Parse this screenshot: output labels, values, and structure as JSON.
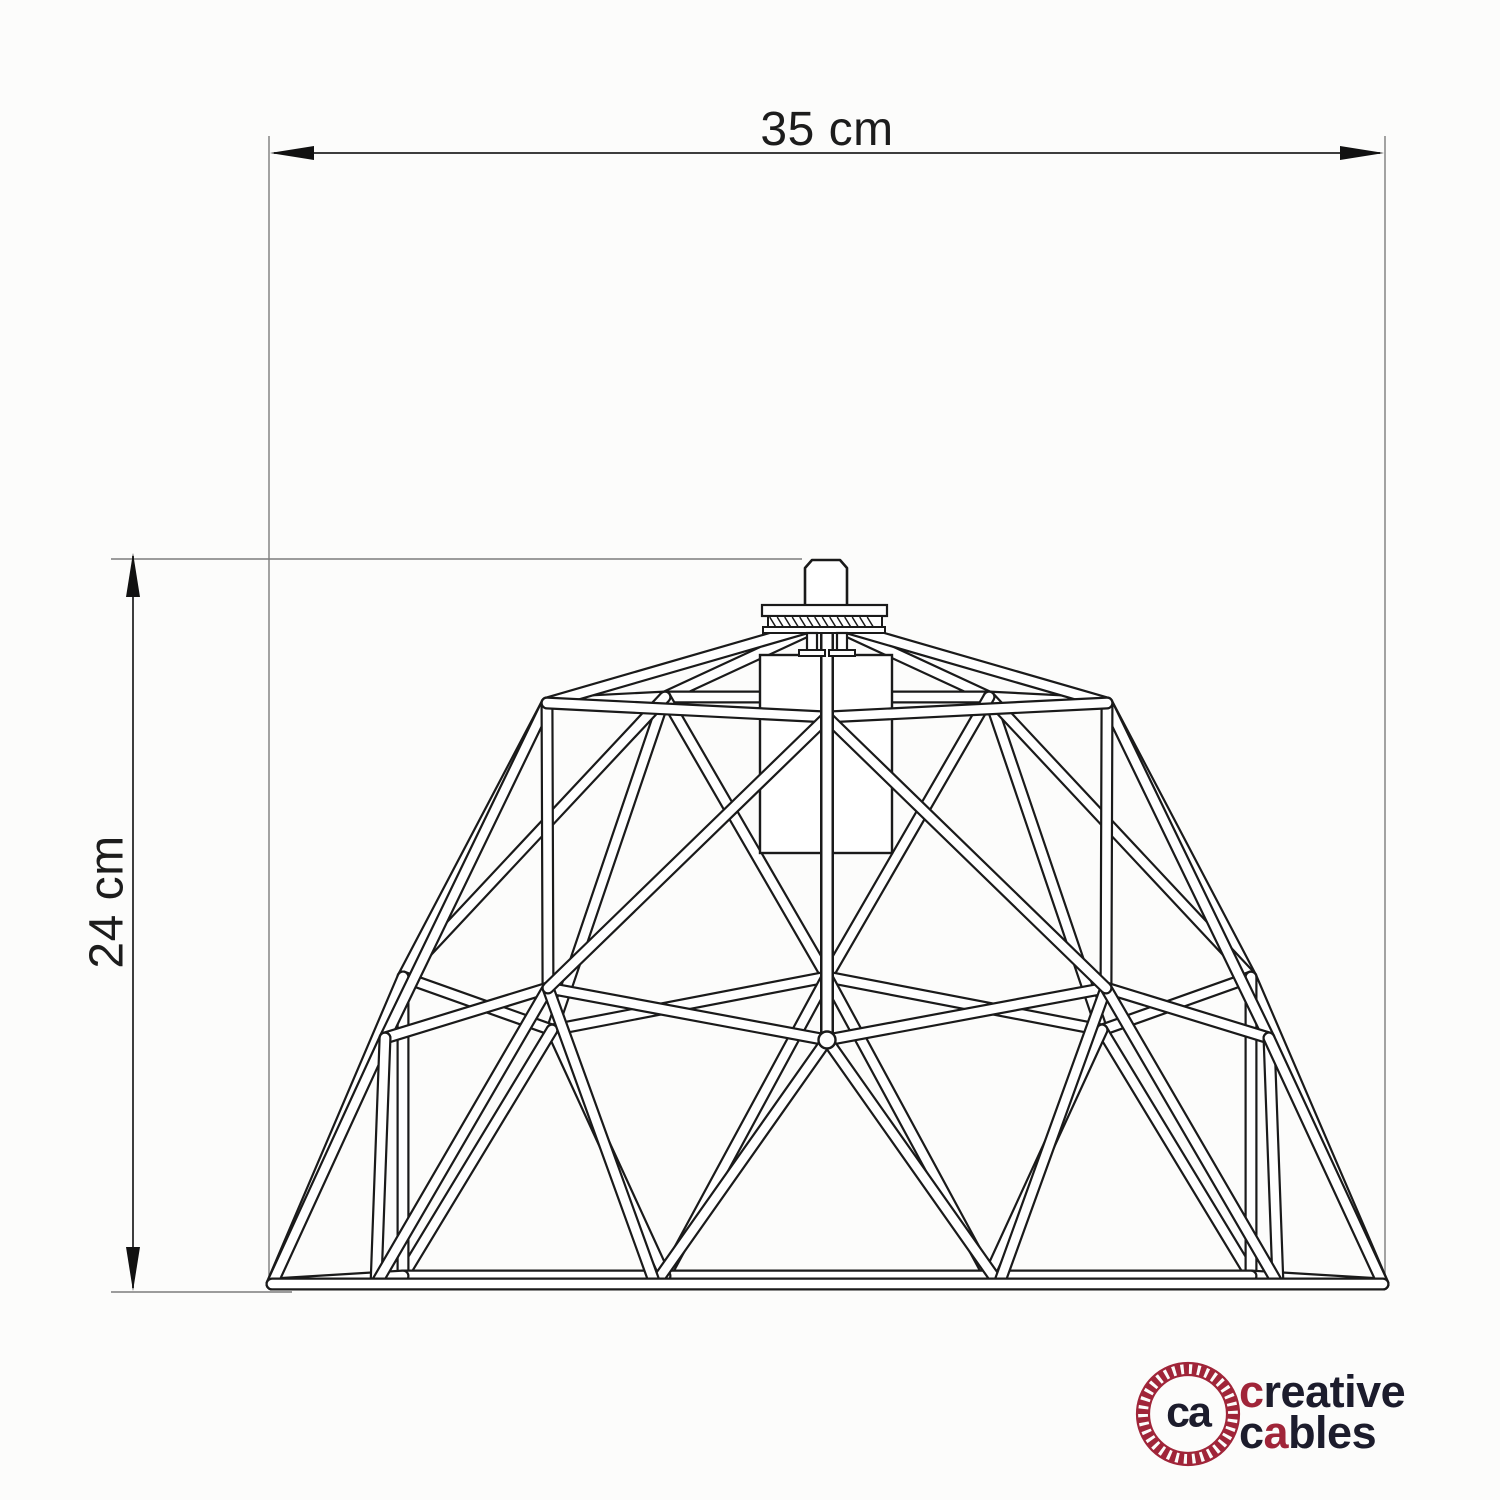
{
  "drawing": {
    "title": "cage lampshade dimension drawing",
    "width_dimension_label": "35 cm",
    "height_dimension_label": "24 cm"
  },
  "brand": {
    "monogram": "ca",
    "wordmark_line1": {
      "first_letter": "c",
      "rest": "reative"
    },
    "wordmark_line2": {
      "first_letter": "c",
      "accent_letter": "a",
      "rest": "bles"
    },
    "accent_color": "#a02539",
    "ink_color": "#1c1c2c",
    "line_color": "#1a1a1a"
  }
}
